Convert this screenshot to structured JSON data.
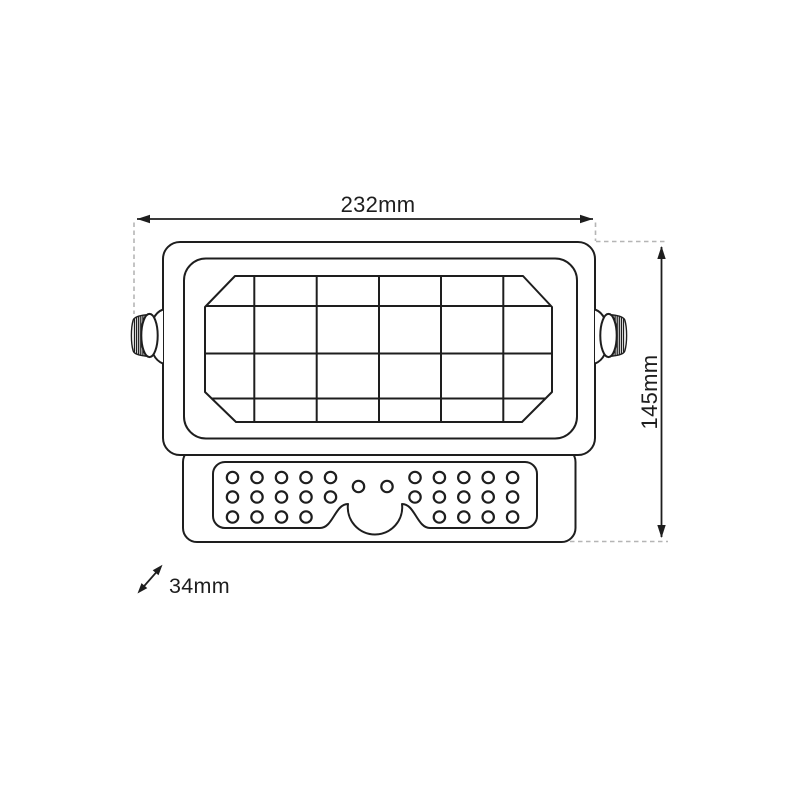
{
  "drawing": {
    "type": "technical-dimension-diagram",
    "product": "solar-led-floodlight-front-view",
    "labels": {
      "width": "232mm",
      "height": "145mm",
      "depth": "34mm"
    },
    "colors": {
      "line": "#1e1e1e",
      "dashed": "#b5b5b5",
      "background": "#ffffff"
    },
    "solar_panel_grid": {
      "columns": 6,
      "rows": 4
    },
    "led_matrix": {
      "left_rows": [
        5,
        5,
        4
      ],
      "center_dots": 2,
      "right_rows": [
        5,
        5,
        4
      ]
    }
  }
}
